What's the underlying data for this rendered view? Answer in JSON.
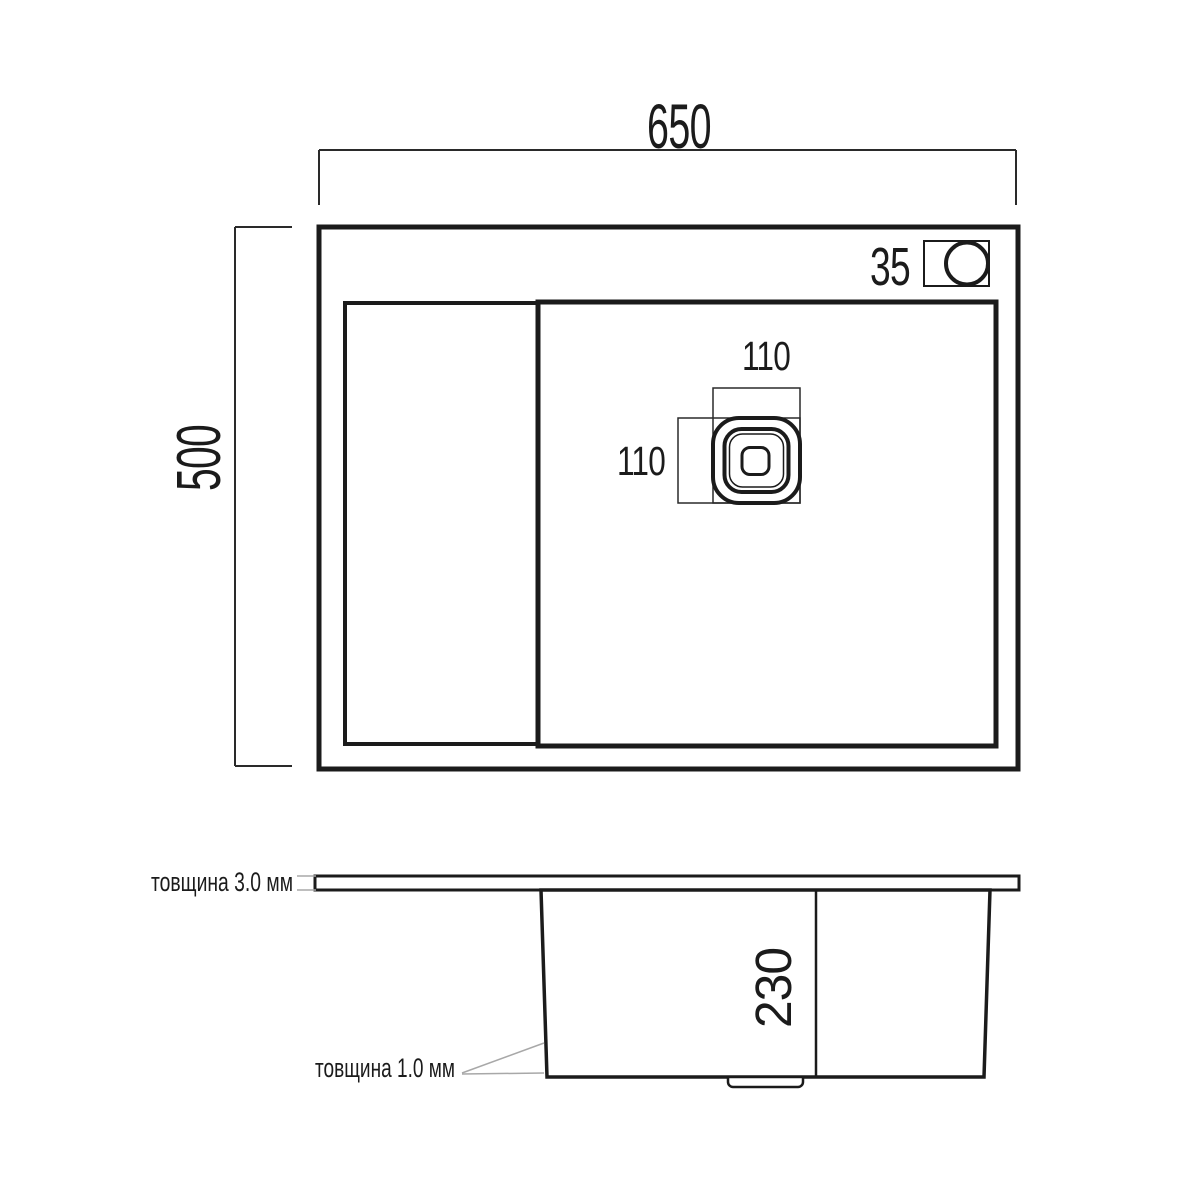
{
  "colors": {
    "line": "#1b1b1b",
    "dimension_line": "#2a2a2a",
    "leader_line": "#a8a8a8",
    "background": "#ffffff"
  },
  "top_view": {
    "overall_width_mm": "650",
    "overall_depth_mm": "500",
    "faucet_hole_mm": "35",
    "drain_width_mm": "110",
    "drain_height_mm": "110"
  },
  "side_view": {
    "rim_thickness_label": "товщина 3.0 мм",
    "bowl_depth_mm": "230",
    "wall_thickness_label": "товщина 1.0 мм"
  }
}
